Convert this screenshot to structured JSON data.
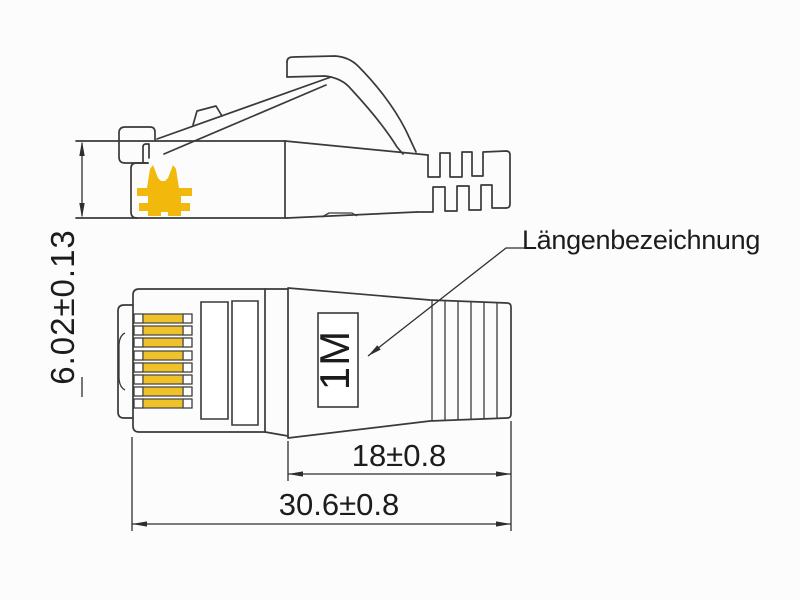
{
  "drawing": {
    "kind": "technical-dimension-drawing",
    "labels": {
      "length_designation": "Längenbezeichnung",
      "boot_marking": "1M"
    },
    "dimensions": {
      "plug_height": "6.02±0.13",
      "boot_length": "18±0.8",
      "total_length": "30.6±0.8"
    },
    "icons": {
      "crimp_symbol": "double-up-arrows-gold"
    },
    "colors": {
      "line": "#3a3a3a",
      "text": "#1c1c1c",
      "gold_symbol": "#F2B80C",
      "gold_contacts": "#EFC22B",
      "background": "#FCFCFC"
    }
  }
}
